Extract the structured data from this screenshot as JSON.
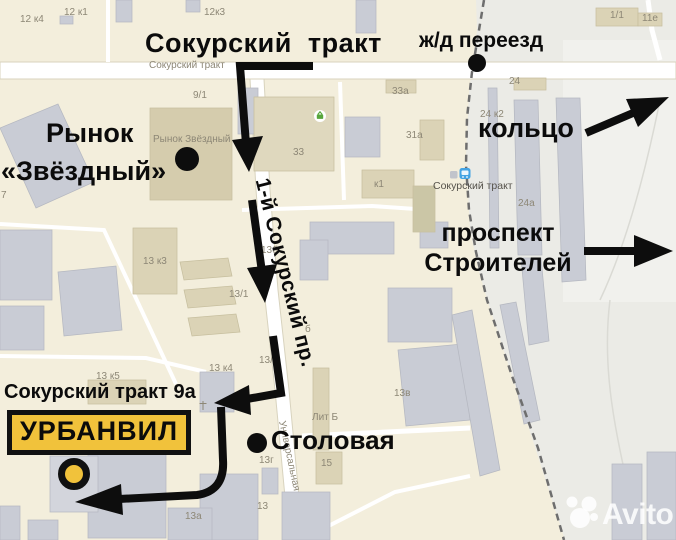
{
  "annotations": {
    "title": "Сокурский  тракт",
    "railway_crossing": "ж/д переезд",
    "market_line1": "Рынок",
    "market_line2": "«Звёздный»",
    "ring": "кольцо",
    "prospekt_line1": "проспект",
    "prospekt_line2": "Строителей",
    "address": "Сокурский тракт 9а",
    "company": "УРБАНВИЛ",
    "canteen": "Столовая",
    "street_rotated": "1-й Сокурский пр."
  },
  "map_labels": [
    {
      "text": "12 к4"
    },
    {
      "text": "12 к1"
    },
    {
      "text": "12к3"
    },
    {
      "text": "Сокурский тракт"
    },
    {
      "text": "1/1"
    },
    {
      "text": "11е"
    },
    {
      "text": "9/1"
    },
    {
      "text": "33а"
    },
    {
      "text": "24"
    },
    {
      "text": "24 к2"
    },
    {
      "text": "Рынок Звёздный"
    },
    {
      "text": "33"
    },
    {
      "text": "31а"
    },
    {
      "text": "к1"
    },
    {
      "text": "Сокурский тракт"
    },
    {
      "text": "24а"
    },
    {
      "text": "13 к3"
    },
    {
      "text": "13б"
    },
    {
      "text": "13/1"
    },
    {
      "text": "б"
    },
    {
      "text": "13/2"
    },
    {
      "text": "13 к5"
    },
    {
      "text": "13 к4"
    },
    {
      "text": "13в"
    },
    {
      "text": "Лит Б"
    },
    {
      "text": "13г"
    },
    {
      "text": "15"
    },
    {
      "text": "Универсальная"
    },
    {
      "text": "13"
    },
    {
      "text": "13а"
    },
    {
      "text": "7"
    }
  ],
  "watermark": {
    "brand": "Avito"
  },
  "colors": {
    "accent_yellow": "#F1C23B",
    "route_black": "#0D0D0D",
    "station_blue": "#44A3E3",
    "poi_green": "#57A63C"
  }
}
